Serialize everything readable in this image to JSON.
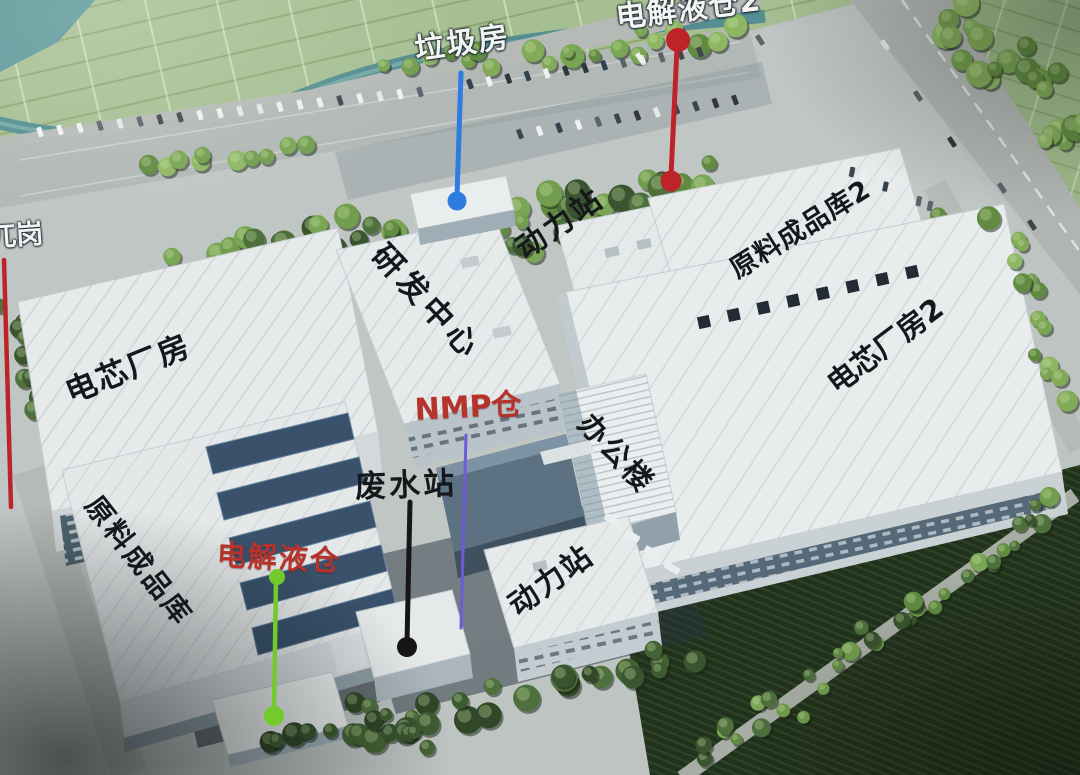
{
  "scene": {
    "type": "aerial-campus-rendering",
    "description": "Photographed aerial rendering of a battery factory campus with labeled buildings and colored location pins"
  },
  "labels": [
    {
      "id": "edge-road",
      "text": "兀岗",
      "style": "white-outline"
    },
    {
      "id": "garbage-room",
      "text": "垃圾房",
      "style": "white-outline"
    },
    {
      "id": "electrolyte-warehouse-2",
      "text": "电解液仓2",
      "style": "white-outline"
    },
    {
      "id": "power-station-north",
      "text": "动力站",
      "style": "black-roof"
    },
    {
      "id": "rd-center",
      "text": "研发中心",
      "style": "black-roof"
    },
    {
      "id": "raw-material-warehouse-2",
      "text": "原料成品库2",
      "style": "black-roof"
    },
    {
      "id": "cell-plant-2",
      "text": "电芯厂房2",
      "style": "black-roof"
    },
    {
      "id": "cell-plant-1",
      "text": "电芯厂房",
      "style": "black-roof"
    },
    {
      "id": "office-building",
      "text": "办公楼",
      "style": "black-roof"
    },
    {
      "id": "nmp-warehouse",
      "text": "NMP仓",
      "style": "red"
    },
    {
      "id": "wastewater-station",
      "text": "废水站",
      "style": "black-roof"
    },
    {
      "id": "raw-material-warehouse-1",
      "text": "原料成品库",
      "style": "black-roof"
    },
    {
      "id": "electrolyte-warehouse-1",
      "text": "电解液仓",
      "style": "red"
    },
    {
      "id": "power-station-south",
      "text": "动力站",
      "style": "black-roof"
    }
  ],
  "pins": [
    {
      "id": "garbage-room-pin",
      "color": "#2e7ce0",
      "links_label": "垃圾房"
    },
    {
      "id": "electrolyte-warehouse-2-pin",
      "color": "#bf232a",
      "links_label": "电解液仓2"
    },
    {
      "id": "left-edge-pin",
      "color": "#bf232a",
      "links_label": ""
    },
    {
      "id": "electrolyte-warehouse-1-pin",
      "color": "#74c92c",
      "links_label": "电解液仓"
    },
    {
      "id": "nmp-warehouse-pin",
      "color": "#6f5bd8",
      "links_label": "NMP仓"
    },
    {
      "id": "wastewater-station-pin",
      "color": "#161616",
      "links_label": "废水站"
    }
  ],
  "palette": {
    "label_white": "#f2f5f3",
    "label_black": "#15181b",
    "label_red": "#b5332b",
    "roof_white": "#e9edee",
    "vegetation_dark": "#24381d",
    "water": "#4f8f92"
  }
}
